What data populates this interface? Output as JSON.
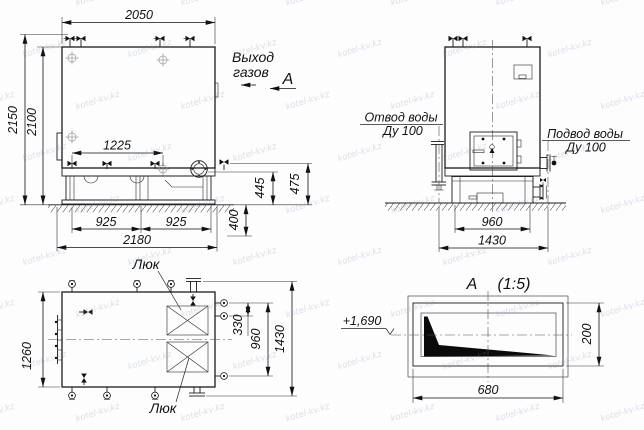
{
  "watermark": {
    "text": "kotel-kv.kz"
  },
  "front_view": {
    "width_top": "2050",
    "height_total": "2150",
    "height_body": "2100",
    "bolt_spacing": "1225",
    "base_left": "925",
    "base_right": "925",
    "base_total": "2180",
    "foundation_depth": "400",
    "flange_height": "445",
    "valve_height": "475",
    "gas_outlet_line1": "Выход",
    "gas_outlet_line2": "газов",
    "section_label": "А",
    "hatch_label": "Люк"
  },
  "side_view": {
    "water_outlet_line1": "Отвод воды",
    "water_outlet_line2": "Ду 100",
    "water_inlet_line1": "Подвод воды",
    "water_inlet_line2": "Ду 100",
    "base_width": "960",
    "total_width": "1430"
  },
  "plan_view": {
    "width": "1260",
    "stub_spacing": "330",
    "stub_span": "960",
    "total_height": "1430",
    "hatch_label_bottom": "Люк"
  },
  "detail_a": {
    "title": "А",
    "scale": "(1:5)",
    "elevation": "+1,690",
    "width": "680",
    "height": "200"
  }
}
